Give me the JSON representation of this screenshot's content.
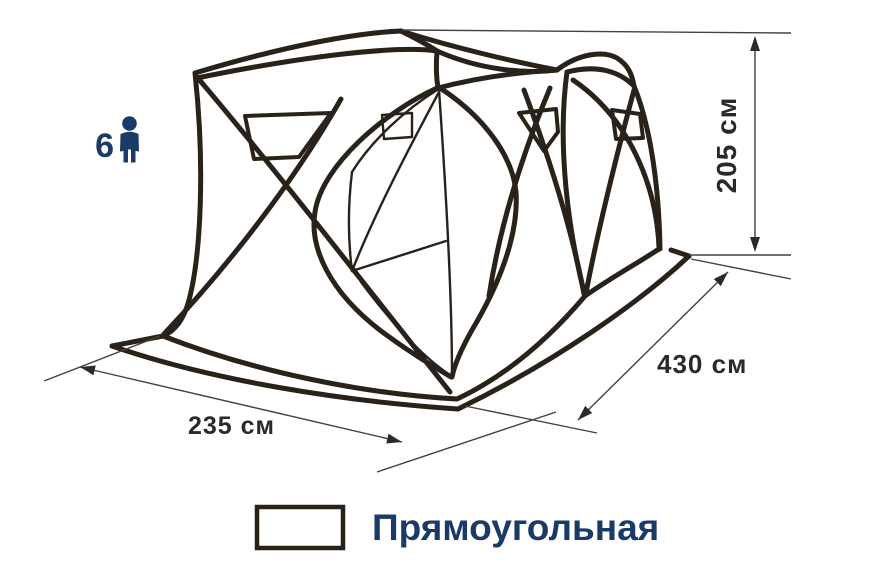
{
  "figure": {
    "type": "tent-dimension-diagram",
    "capacity": {
      "count": "6",
      "icon": "person-icon"
    },
    "dimensions": {
      "height_label": "205 см",
      "depth_label": "430 см",
      "width_label": "235 см"
    },
    "legend": {
      "swatch_icon": "rectangle-icon",
      "shape_label": "Прямоугольная"
    },
    "colors": {
      "line": "#29221a",
      "navy": "#1a3a68",
      "dimension_text": "#2b2a28",
      "thin_line": "#45413c",
      "background": "#ffffff"
    }
  }
}
